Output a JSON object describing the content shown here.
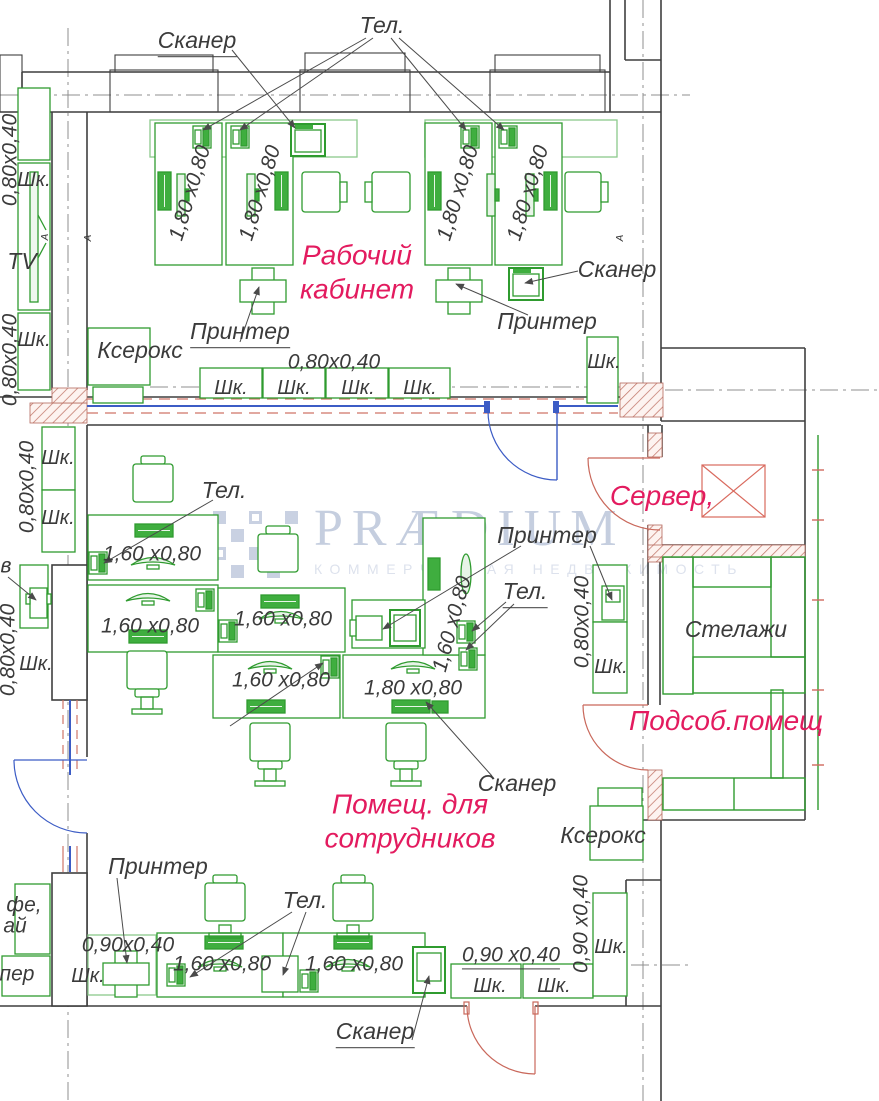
{
  "meta": {
    "drawing_type": "office floor plan",
    "language": "ru"
  },
  "colors": {
    "furniture_green": "#2f9b2f",
    "furniture_fill": "#3fae3f",
    "room_label_magenta": "#e31b5f",
    "wall_dark": "#3f3f3f",
    "door_red": "#c9685b",
    "partition_blue": "#3c5cc5",
    "axis_gray": "#8f8f8f",
    "hatch_red": "#c2786b",
    "watermark_blue_gray": "#c5cedf"
  },
  "watermark": {
    "logo": "PRÆDIUM",
    "tagline": "КОММЕРЧЕСКАЯ НЕДВИЖИМОСТЬ"
  },
  "rooms": [
    "Рабочий кабинет",
    "Помещ. для сотрудников",
    "Сервер,",
    "Подсоб.помещ"
  ],
  "labels": [
    {
      "name": "skaner-top-label",
      "text": "Сканер",
      "x": 197,
      "y": 42,
      "kind": "equip",
      "ul": true
    },
    {
      "name": "tel-top-label",
      "text": "Тел.",
      "x": 382,
      "y": 26,
      "kind": "equip"
    },
    {
      "name": "dim-left-upper",
      "text": "0,80х0,40",
      "x": 10,
      "y": 160,
      "kind": "dim",
      "rot": -90
    },
    {
      "name": "cab-left-1",
      "text": "Шк.",
      "x": 34,
      "y": 180,
      "kind": "cab"
    },
    {
      "name": "tv-label",
      "text": "TV",
      "x": 22,
      "y": 262,
      "kind": "equip"
    },
    {
      "name": "cab-left-2",
      "text": "Шк.",
      "x": 34,
      "y": 340,
      "kind": "cab"
    },
    {
      "name": "dim-left-lower",
      "text": "0,80х0,40",
      "x": 10,
      "y": 360,
      "kind": "dim",
      "rot": -90
    },
    {
      "name": "desk1-dim",
      "text": "1,80 х0,80",
      "x": 190,
      "y": 193,
      "kind": "dim",
      "rot": -73
    },
    {
      "name": "desk2-dim",
      "text": "1,80 х0,80",
      "x": 260,
      "y": 193,
      "kind": "dim",
      "rot": -73
    },
    {
      "name": "desk3-dim",
      "text": "1,80 х0,80",
      "x": 458,
      "y": 193,
      "kind": "dim",
      "rot": -73
    },
    {
      "name": "desk4-dim",
      "text": "1,80 х0,80",
      "x": 528,
      "y": 193,
      "kind": "dim",
      "rot": -73
    },
    {
      "name": "room-office-label",
      "text": "Рабочий\nкабинет",
      "x": 357,
      "y": 272,
      "kind": "room"
    },
    {
      "name": "skaner-right-label",
      "text": "Сканер",
      "x": 617,
      "y": 270,
      "kind": "equip"
    },
    {
      "name": "printer-left-label",
      "text": "Принтер",
      "x": 240,
      "y": 333,
      "kind": "equip",
      "ul": true
    },
    {
      "name": "printer-right-label",
      "text": "Принтер",
      "x": 547,
      "y": 322,
      "kind": "equip"
    },
    {
      "name": "kserox-top-label",
      "text": "Ксерокс",
      "x": 140,
      "y": 351,
      "kind": "equip"
    },
    {
      "name": "dim-cab-row",
      "text": "0,80х0,40",
      "x": 334,
      "y": 362,
      "kind": "dim"
    },
    {
      "name": "cab-row-1",
      "text": "Шк.",
      "x": 231,
      "y": 388,
      "kind": "cab"
    },
    {
      "name": "cab-row-2",
      "text": "Шк.",
      "x": 294,
      "y": 388,
      "kind": "cab"
    },
    {
      "name": "cab-row-3",
      "text": "Шк.",
      "x": 358,
      "y": 388,
      "kind": "cab"
    },
    {
      "name": "cab-row-4",
      "text": "Шк.",
      "x": 420,
      "y": 388,
      "kind": "cab"
    },
    {
      "name": "cab-right-top",
      "text": "Шк.",
      "x": 604,
      "y": 362,
      "kind": "cab"
    },
    {
      "name": "dim-ml-upper",
      "text": "0,80х0,40",
      "x": 27,
      "y": 487,
      "kind": "dim",
      "rot": -90
    },
    {
      "name": "cab-ml-1",
      "text": "Шк.",
      "x": 58,
      "y": 458,
      "kind": "cab"
    },
    {
      "name": "cab-ml-2",
      "text": "Шк.",
      "x": 58,
      "y": 518,
      "kind": "cab"
    },
    {
      "name": "tel-ml-label",
      "text": "Тел.",
      "x": 224,
      "y": 491,
      "kind": "equip"
    },
    {
      "name": "deskA-dim",
      "text": "1,60 х0,80",
      "x": 152,
      "y": 554,
      "kind": "dim"
    },
    {
      "name": "deskB-dim",
      "text": "1,60 х0,80",
      "x": 150,
      "y": 626,
      "kind": "dim"
    },
    {
      "name": "deskC-dim",
      "text": "1,60 х0,80",
      "x": 283,
      "y": 619,
      "kind": "dim"
    },
    {
      "name": "deskC2-dim",
      "text": "1,60 х0,80",
      "x": 281,
      "y": 680,
      "kind": "dim"
    },
    {
      "name": "deskD-dim",
      "text": "1,80 х0,80",
      "x": 413,
      "y": 688,
      "kind": "dim"
    },
    {
      "name": "deskV-dim",
      "text": "1,60 х0,80",
      "x": 452,
      "y": 624,
      "kind": "dim",
      "rot": -75
    },
    {
      "name": "frag-left-mid",
      "text": "в",
      "x": 6,
      "y": 566,
      "kind": "frag"
    },
    {
      "name": "dim-ml-lower",
      "text": "0,80х0,40",
      "x": 8,
      "y": 650,
      "kind": "dim",
      "rot": -90
    },
    {
      "name": "cab-ml-3",
      "text": "Шк.",
      "x": 36,
      "y": 664,
      "kind": "cab"
    },
    {
      "name": "server-label",
      "text": "Сервер,",
      "x": 662,
      "y": 496,
      "kind": "room"
    },
    {
      "name": "printer-mid-label",
      "text": "Принтер",
      "x": 547,
      "y": 536,
      "kind": "equip"
    },
    {
      "name": "tel-mid-label",
      "text": "Тел.",
      "x": 525,
      "y": 593,
      "kind": "equip",
      "ul": true
    },
    {
      "name": "dim-mr",
      "text": "0,80х0,40",
      "x": 582,
      "y": 622,
      "kind": "dim",
      "rot": -90
    },
    {
      "name": "cab-mr",
      "text": "Шк.",
      "x": 611,
      "y": 667,
      "kind": "cab"
    },
    {
      "name": "stelazhi-label",
      "text": "Стелажи",
      "x": 736,
      "y": 630,
      "kind": "equip"
    },
    {
      "name": "podsob-label",
      "text": "Подсоб.помещ",
      "x": 726,
      "y": 721,
      "kind": "room"
    },
    {
      "name": "room-staff-label",
      "text": "Помещ. для\nсотрудников",
      "x": 410,
      "y": 821,
      "kind": "room"
    },
    {
      "name": "skaner-mid-label",
      "text": "Сканер",
      "x": 517,
      "y": 784,
      "kind": "equip"
    },
    {
      "name": "kserox-bottom-label",
      "text": "Ксерокс",
      "x": 603,
      "y": 836,
      "kind": "equip"
    },
    {
      "name": "printer-bottom-label",
      "text": "Принтер",
      "x": 158,
      "y": 867,
      "kind": "equip"
    },
    {
      "name": "tel-bottom-label",
      "text": "Тел.",
      "x": 305,
      "y": 901,
      "kind": "equip"
    },
    {
      "name": "dim-bl",
      "text": "0,90х0,40",
      "x": 128,
      "y": 945,
      "kind": "dim"
    },
    {
      "name": "cab-bl",
      "text": "Шк.",
      "x": 88,
      "y": 976,
      "kind": "cab"
    },
    {
      "name": "deskE-dim",
      "text": "1,60 х0,80",
      "x": 222,
      "y": 964,
      "kind": "dim"
    },
    {
      "name": "deskF-dim",
      "text": "1,60 х0,80",
      "x": 354,
      "y": 964,
      "kind": "dim"
    },
    {
      "name": "skaner-bottom-label",
      "text": "Сканер",
      "x": 375,
      "y": 1033,
      "kind": "equip",
      "ul": true
    },
    {
      "name": "dim-br",
      "text": "0,90 х0,40",
      "x": 511,
      "y": 956,
      "kind": "dim",
      "ul": true
    },
    {
      "name": "cab-br-1",
      "text": "Шк.",
      "x": 490,
      "y": 986,
      "kind": "cab"
    },
    {
      "name": "cab-br-2",
      "text": "Шк.",
      "x": 554,
      "y": 986,
      "kind": "cab"
    },
    {
      "name": "dim-br-vert",
      "text": "0,90 х0,40",
      "x": 581,
      "y": 924,
      "kind": "dim",
      "rot": -90
    },
    {
      "name": "cab-br-right",
      "text": "Шк.",
      "x": 611,
      "y": 947,
      "kind": "cab"
    },
    {
      "name": "frag-coffee-1",
      "text": "фе,",
      "x": 24,
      "y": 905,
      "kind": "frag"
    },
    {
      "name": "frag-coffee-2",
      "text": "ай",
      "x": 15,
      "y": 926,
      "kind": "frag"
    },
    {
      "name": "frag-printer",
      "text": "пер",
      "x": 17,
      "y": 974,
      "kind": "frag"
    },
    {
      "name": "section-marker-a",
      "text": "А",
      "x": 46,
      "y": 237,
      "kind": "marker",
      "rot": -90
    },
    {
      "name": "section-marker-b",
      "text": "А",
      "x": 89,
      "y": 238,
      "kind": "marker",
      "rot": -90
    },
    {
      "name": "section-marker-c",
      "text": "А",
      "x": 621,
      "y": 238,
      "kind": "marker",
      "rot": -90
    }
  ]
}
